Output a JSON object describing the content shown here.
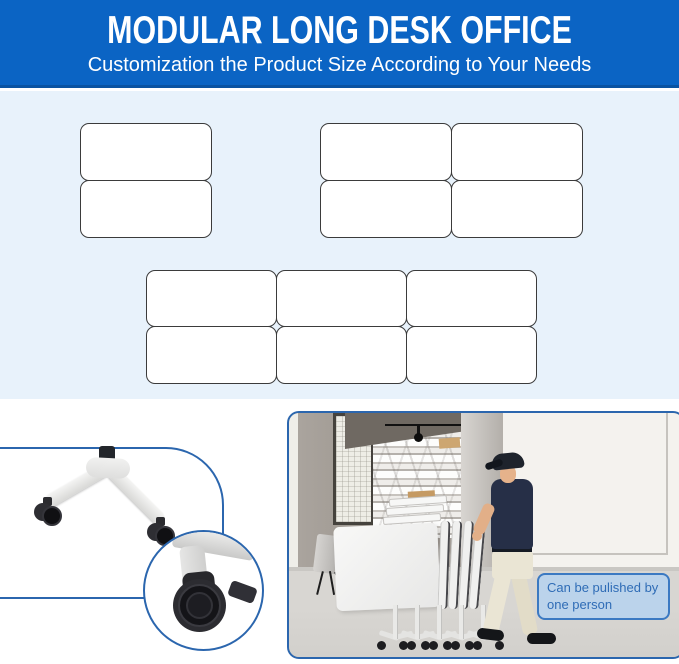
{
  "header": {
    "title": "MODULAR LONG DESK OFFICE",
    "subtitle": "Customization the Product Size According to Your Needs",
    "bg_color": "#0b64c4",
    "text_color": "#ffffff"
  },
  "desk_layouts": [
    {
      "id": "two-desk-layout",
      "rows": 2,
      "cols": 1,
      "desk_count": 2
    },
    {
      "id": "four-desk-layout",
      "rows": 2,
      "cols": 2,
      "desk_count": 4
    },
    {
      "id": "six-desk-layout",
      "rows": 2,
      "cols": 3,
      "desk_count": 6
    }
  ],
  "details": {
    "leg_graphic_icon": "desk-leg-with-casters-icon",
    "closeup_icon": "locking-caster-wheel-icon"
  },
  "photo": {
    "callout_text": "Can be pulished by one person",
    "callout_text_color": "#2f6cb6",
    "callout_border_color": "#3b79c2"
  },
  "colors": {
    "header_blue": "#0b64c4",
    "layout_section_bg": "#e8f2fb",
    "panel_border_blue": "#2b66ae",
    "desk_outline": "#3b3b3b"
  }
}
